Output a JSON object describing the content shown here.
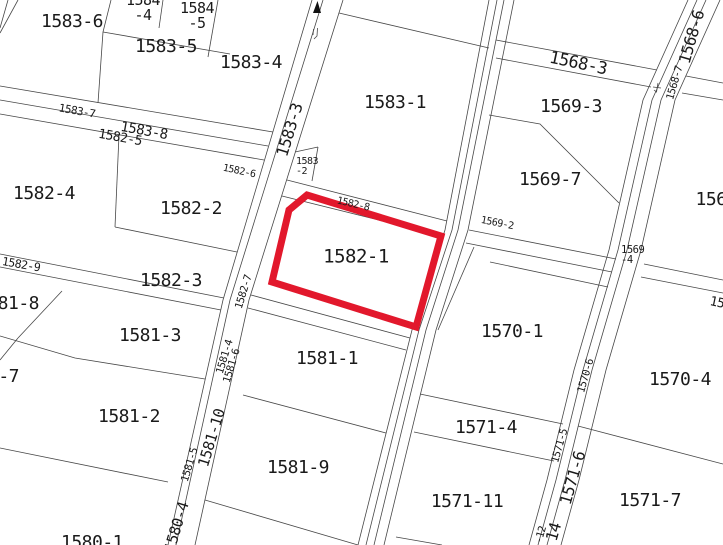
{
  "map": {
    "title": "cadastral-parcel-map",
    "width": 723,
    "height": 545,
    "background": "#ffffff",
    "line_color": "#474747",
    "label_color": "#1a1a1a",
    "highlight_color": "#e2182c",
    "selected_parcel": {
      "label": "1582-1",
      "points": "307,195 441,236 416,327 272,282 289,210",
      "stroke_width": 7
    },
    "north_arrow": {
      "points": "313,13 317.5,1 321,13",
      "color": "#111111"
    },
    "labels": [
      {
        "id": "1583-6",
        "text": "1583-6",
        "x": 72,
        "y": 22,
        "size": 18,
        "rot": 0
      },
      {
        "id": "1584-4",
        "lines": [
          "1584",
          "-4"
        ],
        "x": 143,
        "y": 8,
        "size": 15,
        "lh": 15,
        "rot": 0
      },
      {
        "id": "1584-5",
        "lines": [
          "1584",
          "-5"
        ],
        "x": 197,
        "y": 16,
        "size": 15,
        "lh": 15,
        "rot": 0
      },
      {
        "id": "1583-5",
        "text": "1583-5",
        "x": 166,
        "y": 47,
        "size": 18,
        "rot": 0
      },
      {
        "id": "1583-4",
        "text": "1583-4",
        "x": 251,
        "y": 63,
        "size": 18,
        "rot": 0
      },
      {
        "id": "1583-1",
        "text": "1583-1",
        "x": 395,
        "y": 103,
        "size": 18,
        "rot": 0
      },
      {
        "id": "1568-3",
        "text": "1568-3",
        "x": 578,
        "y": 64,
        "size": 17,
        "rot": 12
      },
      {
        "id": "1569-3",
        "text": "1569-3",
        "x": 571,
        "y": 107,
        "size": 18,
        "rot": 0
      },
      {
        "id": "1568-6",
        "text": "1568-6",
        "x": 692,
        "y": 37,
        "size": 16,
        "rot": -74
      },
      {
        "id": "1568-7",
        "text": "1568-7",
        "x": 675,
        "y": 83,
        "size": 10.5,
        "rot": -74
      },
      {
        "id": "1583-3",
        "text": "1583-3",
        "x": 290,
        "y": 130,
        "size": 16,
        "rot": -73
      },
      {
        "id": "1583-7",
        "text": "1583-7",
        "x": 77,
        "y": 111,
        "size": 11,
        "rot": 10
      },
      {
        "id": "1583-8",
        "text": "1583-8",
        "x": 144,
        "y": 131,
        "size": 14,
        "rot": 10
      },
      {
        "id": "1582-5",
        "text": "1582-5",
        "x": 120,
        "y": 138,
        "size": 13,
        "rot": 10
      },
      {
        "id": "1582-6",
        "text": "1582-6",
        "x": 239,
        "y": 172,
        "size": 10,
        "rot": 12
      },
      {
        "id": "1582-8",
        "text": "1582-8",
        "x": 353,
        "y": 205,
        "size": 10,
        "rot": 13
      },
      {
        "id": "1569-2",
        "text": "1569-2",
        "x": 497,
        "y": 224,
        "size": 10,
        "rot": 11
      },
      {
        "id": "1569-4",
        "lines": [
          "1569",
          "-4"
        ],
        "x": 621,
        "y": 255,
        "size": 10.5,
        "lh": 10,
        "rot": 0,
        "align": "left"
      },
      {
        "id": "1583-2",
        "lines": [
          "1583",
          "-2"
        ],
        "x": 296,
        "y": 167,
        "size": 10,
        "lh": 10,
        "rot": 0,
        "align": "left"
      },
      {
        "id": "1582-4",
        "text": "1582-4",
        "x": 44,
        "y": 194,
        "size": 18,
        "rot": 0
      },
      {
        "id": "1582-2",
        "text": "1582-2",
        "x": 191,
        "y": 209,
        "size": 18,
        "rot": 0
      },
      {
        "id": "1582-9",
        "text": "1582-9",
        "x": 21,
        "y": 265,
        "size": 11.5,
        "rot": 10
      },
      {
        "id": "1582-3",
        "text": "1582-3",
        "x": 171,
        "y": 281,
        "size": 18,
        "rot": 0
      },
      {
        "id": "1581-8",
        "text": "1581-8",
        "x": 8,
        "y": 304,
        "size": 18,
        "rot": 0
      },
      {
        "id": "1582-1",
        "text": "1582-1",
        "x": 356,
        "y": 257,
        "size": 19,
        "rot": 0
      },
      {
        "id": "1582-7",
        "text": "1582-7",
        "x": 244,
        "y": 292,
        "size": 10.5,
        "rot": -73
      },
      {
        "id": "1569-7",
        "text": "1569-7",
        "x": 550,
        "y": 180,
        "size": 18,
        "rot": 0
      },
      {
        "id": "156-partial",
        "text": "156",
        "x": 711,
        "y": 200,
        "size": 18,
        "rot": 0
      },
      {
        "id": "1570-1",
        "text": "1570-1",
        "x": 512,
        "y": 332,
        "size": 18,
        "rot": 0
      },
      {
        "id": "15-partial",
        "text": "15",
        "x": 717,
        "y": 303,
        "size": 13,
        "rot": 12
      },
      {
        "id": "1581-3",
        "text": "1581-3",
        "x": 150,
        "y": 336,
        "size": 18,
        "rot": 0
      },
      {
        "id": "1581-7-partial",
        "text": "1581-7",
        "x": -12,
        "y": 377,
        "size": 18,
        "rot": 0
      },
      {
        "id": "1581-2",
        "text": "1581-2",
        "x": 129,
        "y": 417,
        "size": 18,
        "rot": 0
      },
      {
        "id": "1581-1",
        "text": "1581-1",
        "x": 327,
        "y": 359,
        "size": 18,
        "rot": 0
      },
      {
        "id": "1581-9",
        "text": "1581-9",
        "x": 298,
        "y": 468,
        "size": 18,
        "rot": 0
      },
      {
        "id": "1580-1",
        "text": "1580-1",
        "x": 92,
        "y": 543,
        "size": 18,
        "rot": 0
      },
      {
        "id": "1581-4",
        "text": "1581-4",
        "x": 225,
        "y": 357,
        "size": 10.5,
        "rot": -73
      },
      {
        "id": "1581-6",
        "text": "1581-6",
        "x": 232,
        "y": 366,
        "size": 10.5,
        "rot": -73
      },
      {
        "id": "1581-5",
        "text": "1581-5",
        "x": 190,
        "y": 465,
        "size": 10.5,
        "rot": -73
      },
      {
        "id": "1581-10",
        "text": "1581-10",
        "x": 212,
        "y": 438,
        "size": 15,
        "rot": -73
      },
      {
        "id": "1580-4",
        "text": "1580-4",
        "x": 177,
        "y": 527,
        "size": 15,
        "rot": -73
      },
      {
        "id": "1571-4",
        "text": "1571-4",
        "x": 486,
        "y": 428,
        "size": 18,
        "rot": 0
      },
      {
        "id": "1571-11",
        "text": "1571-11",
        "x": 467,
        "y": 502,
        "size": 18,
        "rot": 0
      },
      {
        "id": "1570-4",
        "text": "1570-4",
        "x": 680,
        "y": 380,
        "size": 18,
        "rot": 0
      },
      {
        "id": "1571-7",
        "text": "1571-7",
        "x": 650,
        "y": 501,
        "size": 18,
        "rot": 0
      },
      {
        "id": "1570-6",
        "text": "1570-6",
        "x": 586,
        "y": 376,
        "size": 10.5,
        "rot": -74
      },
      {
        "id": "1571-5",
        "text": "1571-5",
        "x": 560,
        "y": 446,
        "size": 10.5,
        "rot": -74
      },
      {
        "id": "1571-6",
        "text": "1571-6",
        "x": 573,
        "y": 478,
        "size": 16,
        "rot": -74
      },
      {
        "id": "1571-14-partial",
        "text": "14",
        "x": 554,
        "y": 532,
        "size": 16,
        "rot": -74
      },
      {
        "id": "1571-12-partial",
        "text": "-12",
        "x": 541,
        "y": 535,
        "size": 10.5,
        "rot": -74
      }
    ],
    "lines": [
      "M8,0 L0,28",
      "M18,0 L0,33",
      "M111,0 L103,32 L98,103",
      "M163,0 L159,28",
      "M103,32 L230,54",
      "M218,0 L208,57",
      "M339,13 L489,48",
      "M312,0 L223,300 L168,545",
      "M323,0 L230,300 L176,545",
      "M343,0 L249,300 L195,545",
      "M489,0 L445,230 L412,330 L358,545",
      "M497,0 L452,230 L419,330 L366,545",
      "M504,0 L458,230 L426,330 L374,545",
      "M514,0 L468,230 L436,330 L384,545",
      "M688,0 L643,100 L609,250 L574,370 L547,480 L529,545",
      "M697,0 L652,100 L618,250 L583,370 L556,480 L538,545",
      "M706,0 L661,100 L627,250 L592,370 L565,480 L547,545",
      "M720,0 L675,100 L641,250 L606,370 L579,480 L561,545",
      "M0,86 L273,132",
      "M0,100 L268,146",
      "M0,114 L264,160",
      "M295,152 L318,147",
      "M318,147 L312,181",
      "M287,180 L447,221",
      "M282,196 L443,236",
      "M496,40 L657,70",
      "M686,76 L723,83",
      "M496,58 L651,87",
      "M682,93 L723,100",
      "M489,115 L540,124 L619,203",
      "M469,230 L616,259",
      "M644,264 L723,280",
      "M466,243 L612,272",
      "M641,277 L723,293",
      "M490,262 L608,287",
      "M474,247 L438,330",
      "M0,254 L224,298",
      "M0,267 L221,310",
      "M251,295 L410,338",
      "M248,308 L406,350",
      "M119,135 L115,227",
      "M115,227 L237,252",
      "M62,291 L18,338",
      "M18,338 L0,360",
      "M0,336 L75,358 L205,379",
      "M243,395 L386,433",
      "M0,448 L168,482",
      "M205,500 L358,545",
      "M420,394 L563,424",
      "M414,432 L554,461",
      "M578,426 L723,464",
      "M396,537 L442,545",
      "M313.5,29 L313,35",
      "M317.5,28 L317,36 L314,39",
      "M653,87 L661,88",
      "M658,83 L656.5,92 L654,90"
    ]
  }
}
